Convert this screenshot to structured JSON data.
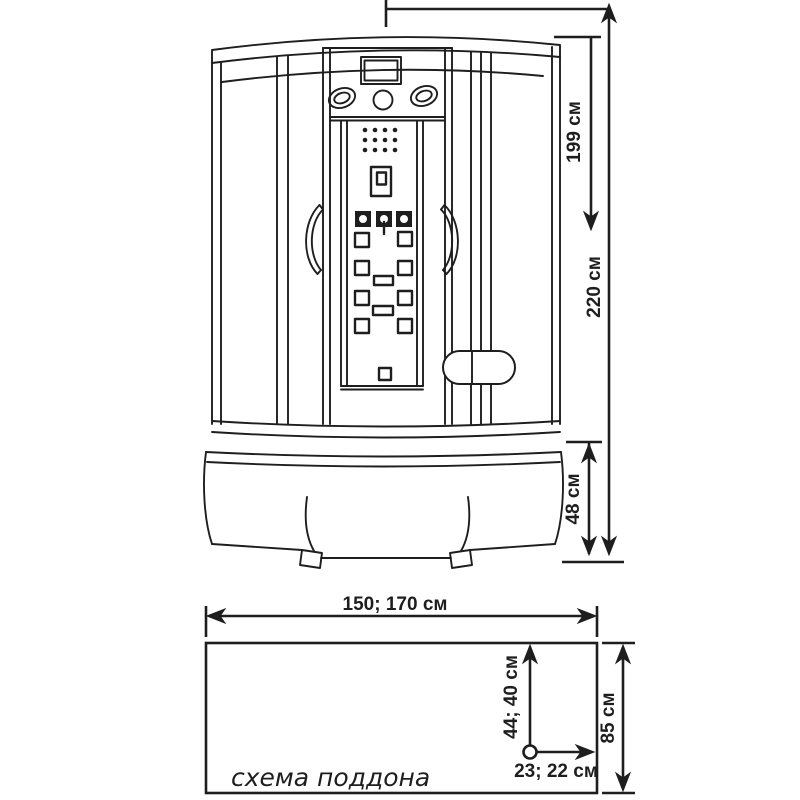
{
  "colors": {
    "line": "#1e1e1e",
    "background": "#ffffff"
  },
  "cabin_view": {
    "dims": {
      "door_height": "199 см",
      "total_height": "220 см",
      "tray_height": "48 см"
    }
  },
  "tray_scheme": {
    "caption": "схема поддона",
    "dims": {
      "width": "150; 170 см",
      "depth": "85 см",
      "drain_from_top": "44; 40 см",
      "drain_from_right": "23; 22 см"
    }
  }
}
